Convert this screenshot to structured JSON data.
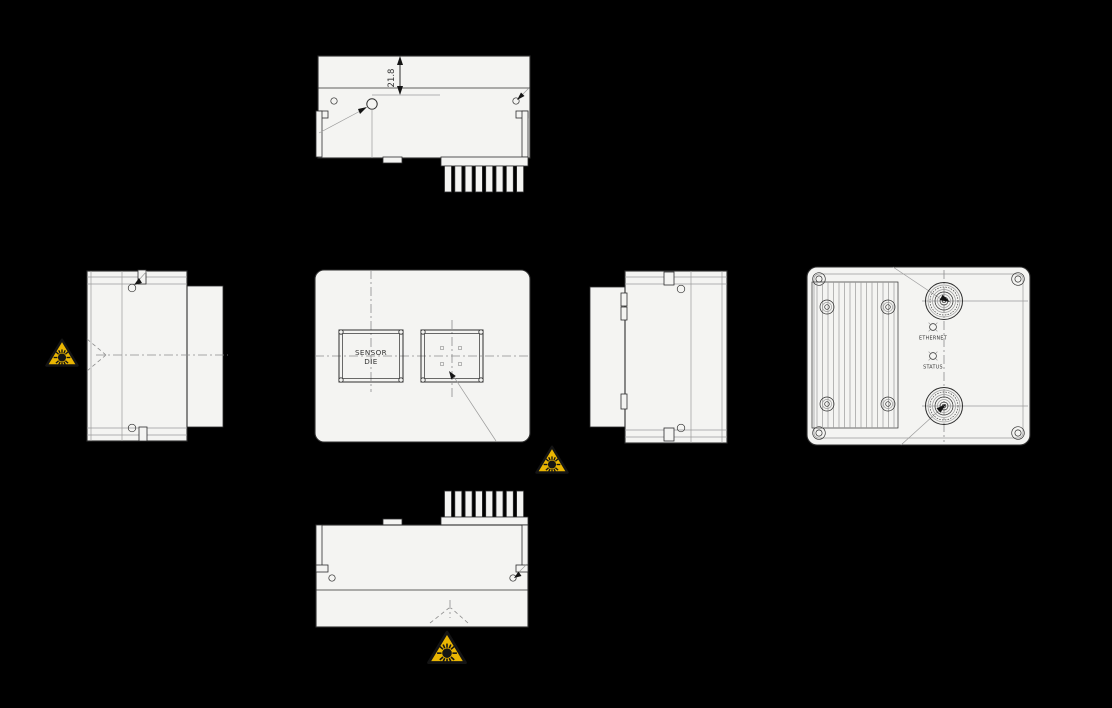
{
  "drawing": {
    "views": {
      "top": {
        "dimension": "21.8"
      },
      "front": {
        "sensor_die": [
          "SENSOR",
          "DIE"
        ]
      },
      "rear": {
        "leds": [
          {
            "label": "ETHERNET"
          },
          {
            "label": "STATUS"
          }
        ]
      }
    },
    "warning": {
      "symbol": "laser-radiation",
      "count": 3
    },
    "colors": {
      "background": "#000000",
      "surface": "#f4f4f2",
      "line_dark": "#2e2e2e",
      "line_light": "#9b9b9b",
      "centerline": "#8c8c8c",
      "warning_yellow": "#e9b502",
      "warning_black": "#141414",
      "text": "#333333"
    }
  }
}
